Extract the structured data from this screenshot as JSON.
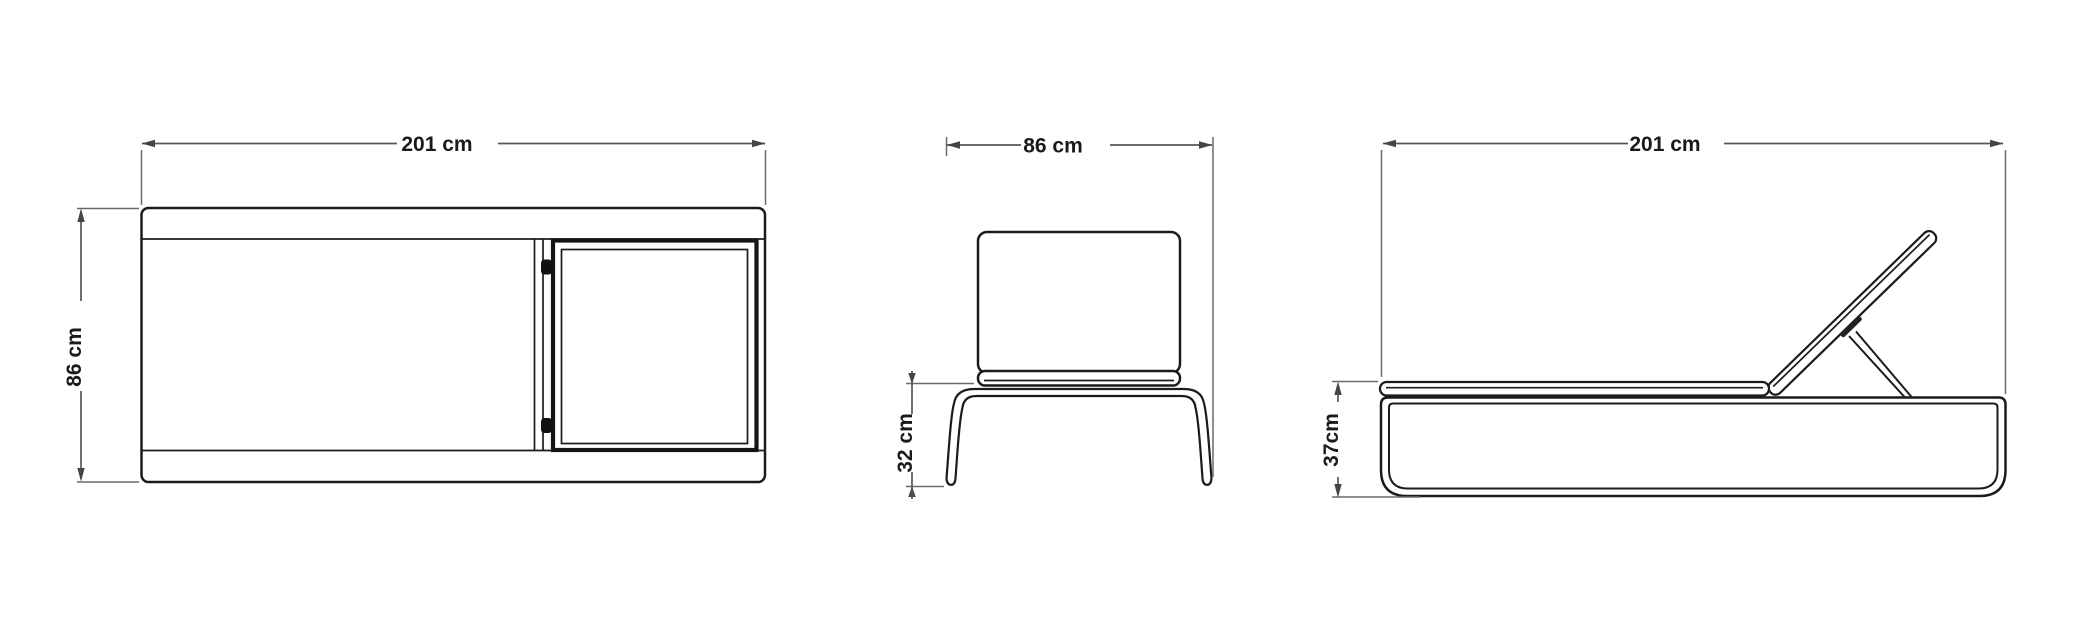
{
  "document": {
    "type": "furniture-dimension-diagram",
    "subject": "sun lounger technical drawing, three orthographic views",
    "background_color": "#ffffff",
    "line_color": "#1b1b1b",
    "dimension_line_color": "#57575a",
    "text_color": "#1a1a1a",
    "unit": "cm"
  },
  "views": {
    "top": {
      "name": "top view",
      "width_label": "201 cm",
      "depth_label": "86 cm"
    },
    "front": {
      "name": "front view",
      "width_label": "86 cm",
      "leg_height_label": "32 cm"
    },
    "side": {
      "name": "side view",
      "length_label": "201 cm",
      "base_height_label": "37cm"
    }
  },
  "chart_data": {
    "type": "table",
    "title": "Lounger dimensions",
    "categories": [
      "overall length",
      "overall depth/width",
      "leg clearance height",
      "base height"
    ],
    "values": [
      201,
      86,
      32,
      37
    ],
    "unit": "cm"
  }
}
